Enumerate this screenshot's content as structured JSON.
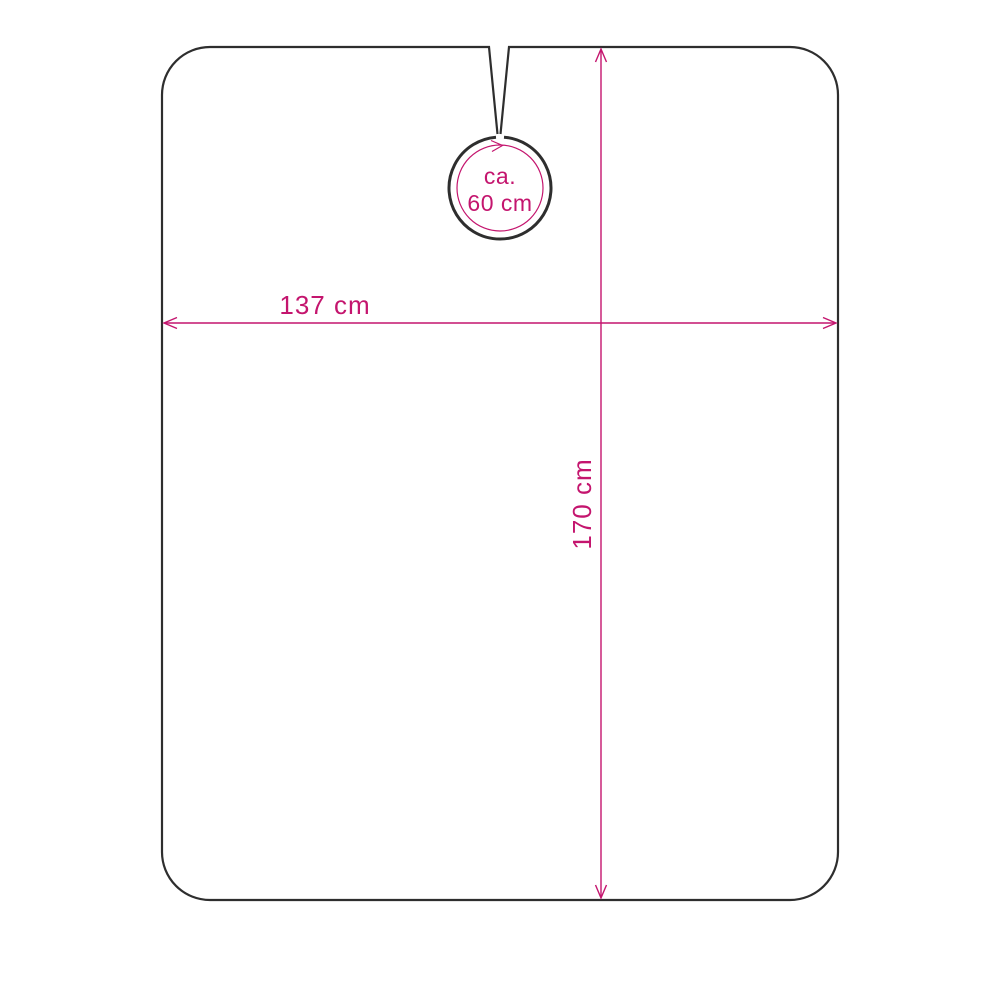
{
  "diagram": {
    "subject": "cape-dimension-drawing",
    "labels": {
      "width": "137 cm",
      "height": "170 cm",
      "neck_line1": "ca.",
      "neck_line2": "60 cm"
    },
    "measurements": {
      "width_cm": 137,
      "height_cm": 170,
      "neck_circumference_cm": 60,
      "neck_is_approximate": true
    },
    "colors": {
      "dimension": "#c4156e",
      "outline": "#2e2e2e",
      "background": "#ffffff"
    }
  }
}
